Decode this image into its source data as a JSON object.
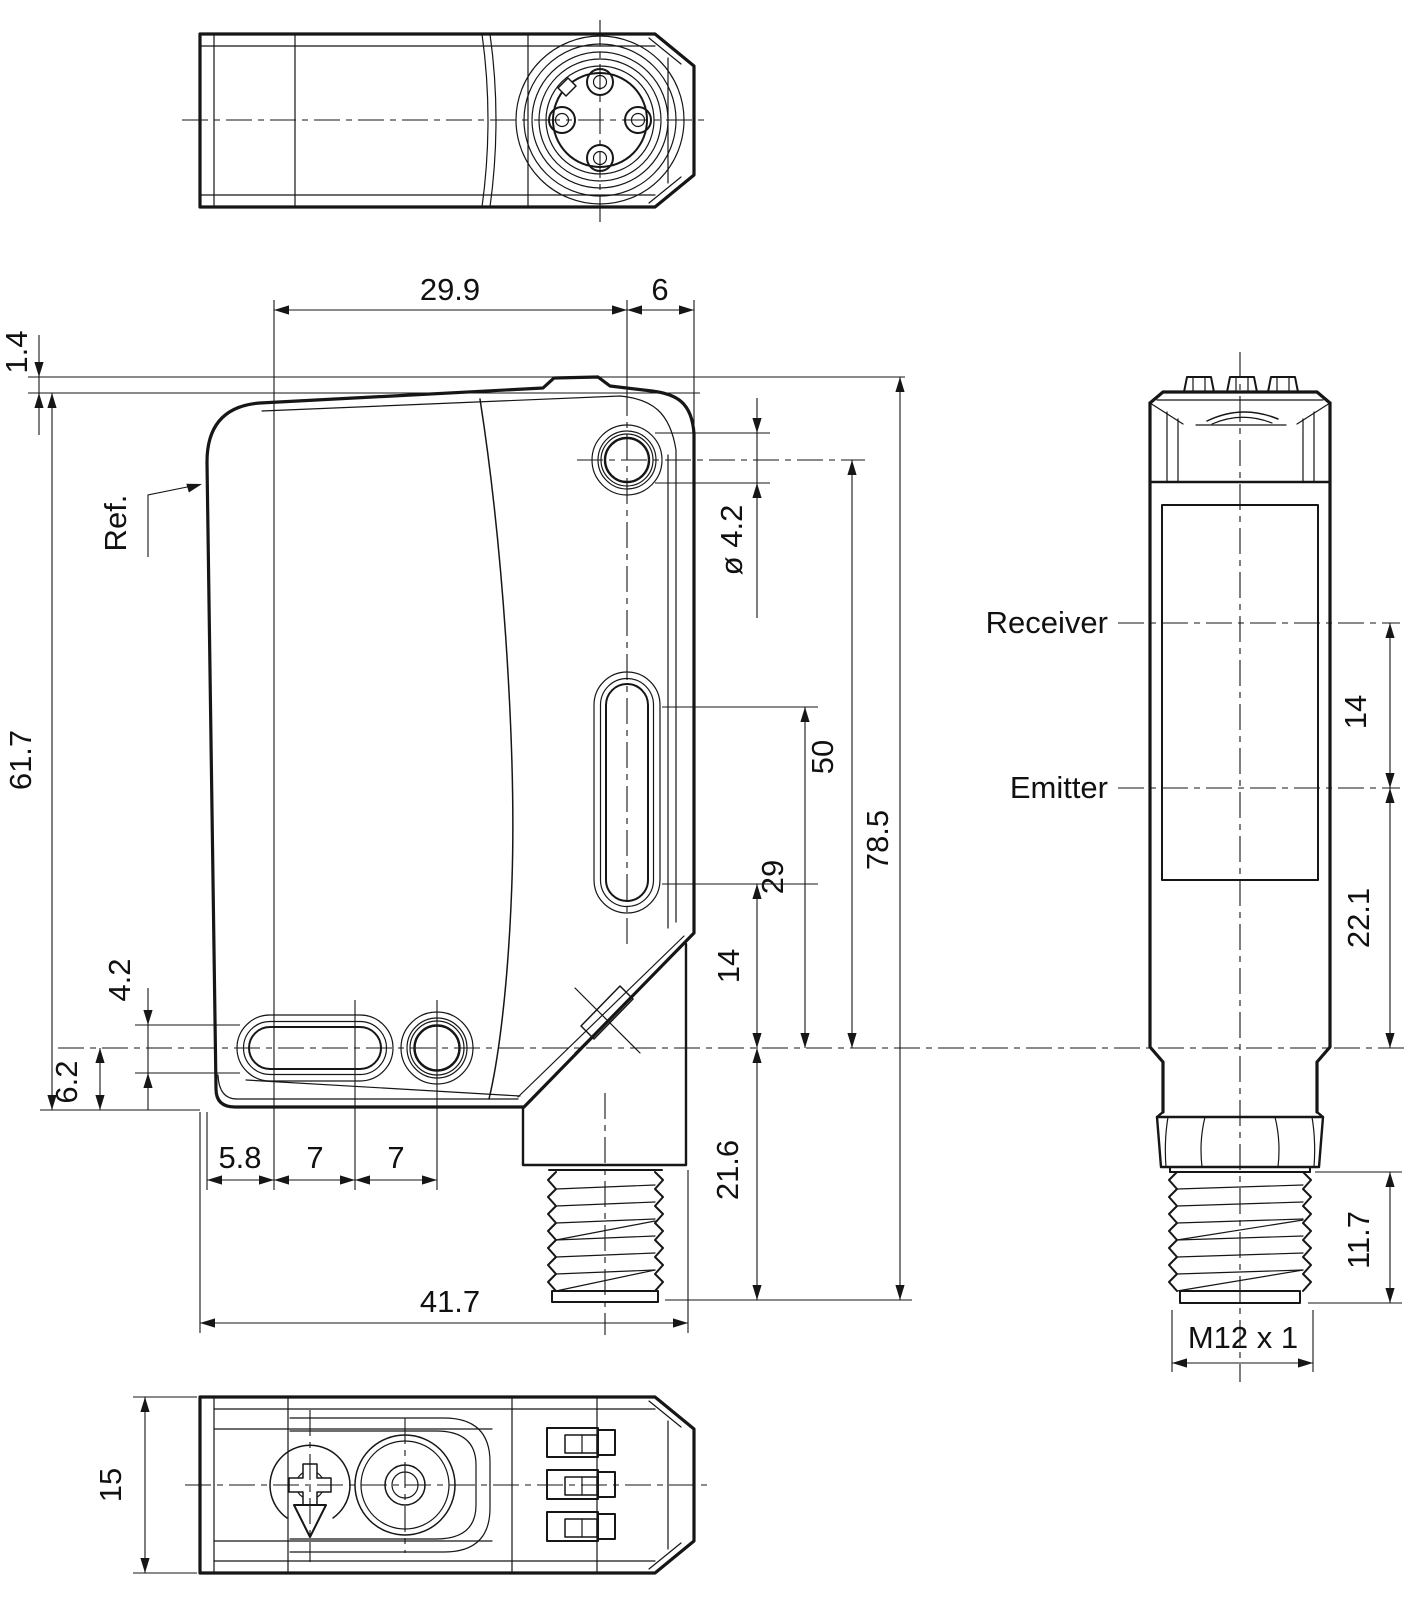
{
  "labels": {
    "ref": "Ref.",
    "receiver": "Receiver",
    "emitter": "Emitter"
  },
  "dimensions": {
    "hole_span_top": "29.9",
    "hole_to_edge": "6",
    "cover_step": "1.4",
    "body_height": "61.7",
    "mount_hole_dia": "ø 4.2",
    "hole_to_axis": "50",
    "slot_top_to_axis": "29",
    "slot_bottom_to_axis": "14",
    "total_height": "78.5",
    "slot_width": "4.2",
    "axis_to_bottom": "6.2",
    "edge_to_slot": "5.8",
    "slot_pitch_a": "7",
    "slot_pitch_b": "7",
    "body_width": "41.7",
    "axis_to_connector_end": "21.6",
    "receiver_to_emitter": "14",
    "emitter_to_axis": "22.1",
    "thread_length": "11.7",
    "thread_spec": "M12 x 1",
    "body_depth": "15"
  }
}
